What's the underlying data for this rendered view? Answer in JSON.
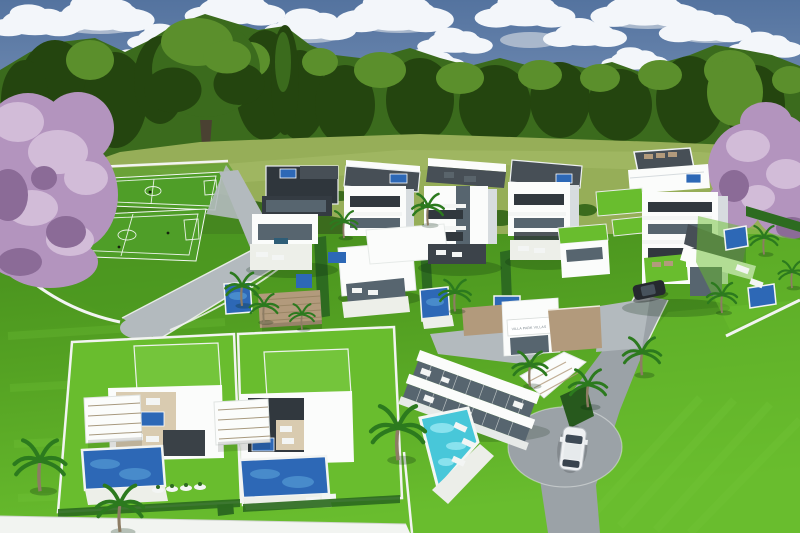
{
  "meta": {
    "description": "Aerial 3D architectural rendering of a gated modern villa development: white flat-roofed villas with private pools, two foreground plots with large pools and pergolas, a clubhouse with a turquoise pool and entrance sign, an access road with a white car, a fenced sports pitch, bright lawns and palm trees, all surrounded by woodland and two flowering purple trees under a partly cloudy blue sky."
  },
  "sign": {
    "text": "VILLA PARK VILLAS"
  },
  "scene": {
    "back_row_villas": 5,
    "foreground_plots": 2,
    "sports_fields": 2,
    "cars": 2,
    "visible_pools": 12
  },
  "colors": {
    "sky_top": "#54739f",
    "sky_mid": "#7b95ba",
    "sky_horizon": "#9db3cf",
    "cloud": "#f3f6fa",
    "cloud_shadow": "#b7c3d3",
    "tree_dark": "#24450f",
    "tree_mid": "#3b6b1d",
    "tree_light": "#5b8f2c",
    "meadow": "#96ae58",
    "meadow_light": "#a8bd6a",
    "blossom": "#b394be",
    "blossom_light": "#d2bcd8",
    "blossom_dark": "#8b6b97",
    "lawn": "#55a323",
    "lawn_bright": "#69bd2e",
    "lawn_dark": "#478f1d",
    "field_green": "#4f9e28",
    "road": "#9ba2a7",
    "road_light": "#b3babe",
    "wall": "#f2f4f1",
    "bldg": "#fbfcfb",
    "bldg_shade": "#d7dcdf",
    "bldg_dark": "#31383e",
    "glass": "#57656f",
    "roof_deck": "#474f56",
    "pergola": "#b29a7c",
    "pergola_light": "#d9cbb0",
    "pool": "#2d68b6",
    "pool_light": "#5fa8dc",
    "pool_cyan": "#48c7d9",
    "hedge": "#2d6b20",
    "palm": "#2c7a1e",
    "trunk": "#8d7c64",
    "car_white": "#eff1f3",
    "car_dark": "#25292e",
    "sign_bg": "#ffffff",
    "sign_text": "#78828a"
  }
}
